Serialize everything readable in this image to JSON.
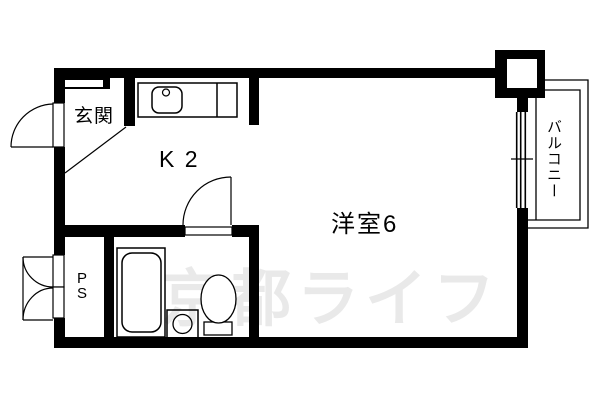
{
  "floorplan": {
    "rooms": {
      "genkan_label": "玄関",
      "kitchen_label": "K 2",
      "main_room_label": "洋室6",
      "balcony_label": "バルコニー",
      "pipe_space_letters": [
        "P",
        "S"
      ]
    },
    "watermark_text": "京都ライフ",
    "colors": {
      "wall": "#000000",
      "line": "#000000",
      "background": "#ffffff",
      "watermark": "#e9e9e9"
    }
  }
}
